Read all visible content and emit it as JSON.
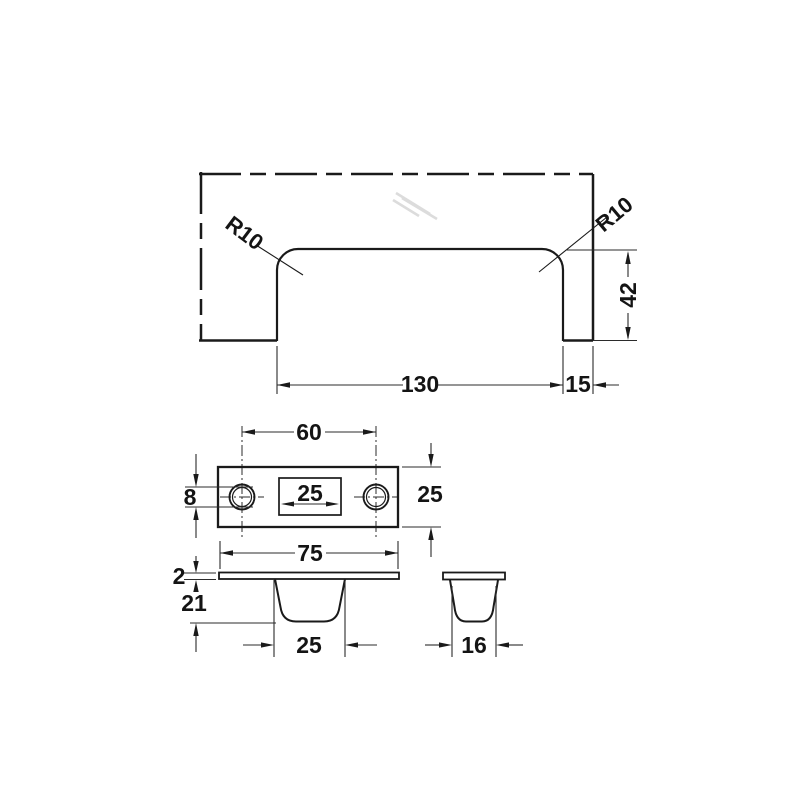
{
  "drawing": {
    "colors": {
      "background": "#ffffff",
      "outline": "#1a1a1a",
      "dimension": "#2b2b2b",
      "hatch": "#dcdcdc"
    },
    "views": {
      "installed_front": {
        "labels": {
          "radius_left": "R10",
          "radius_right": "R10",
          "grip_height": "42",
          "grip_length": "130",
          "edge_distance": "15"
        }
      },
      "plate_top": {
        "labels": {
          "hole_spacing": "60",
          "slot_length": "25",
          "hole_diameter": "8",
          "plate_width": "25"
        }
      },
      "recess_front": {
        "labels": {
          "flange_length": "75",
          "flange_thickness": "2",
          "recess_depth": "21",
          "recess_length": "25"
        }
      },
      "recess_side": {
        "labels": {
          "recess_width": "16"
        }
      }
    }
  }
}
